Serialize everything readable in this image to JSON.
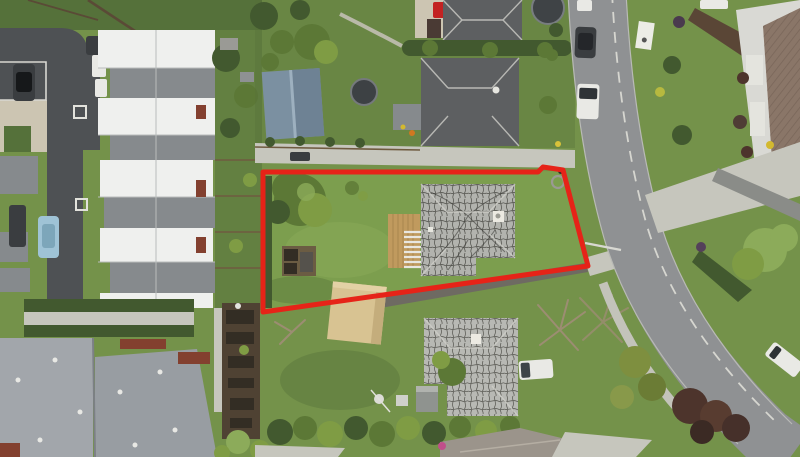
{
  "meta": {
    "type": "aerial-drone-photograph",
    "description": "Aerial real-estate photo of a suburban section outlined in red, surrounded by townhouses on the left, neighbouring houses above and below, and a curved street on the right",
    "width_px": 800,
    "height_px": 457
  },
  "colors": {
    "grass_base": "#74924a",
    "grass_dark": "#55713a",
    "grass_light": "#8cab5a",
    "lot_lawn": "#7c9e4e",
    "road_asphalt": "#8f9193",
    "road_edge": "#b9bab6",
    "road_dash": "#d6d6d0",
    "asphalt_dark": "#4e5154",
    "concrete": "#c6c6bd",
    "concrete_warm": "#ccc5b2",
    "roof_white": "#eff0ee",
    "roof_gray": "#868a8d",
    "roof_dark": "#5d5f61",
    "roof_modern": "#a2a6ab",
    "roof_modern2": "#989da2",
    "brick_red": "#83402f",
    "subject_roof": "#b2b3ae",
    "neighbor_roof": "#b8b9b4",
    "roof_vein": "#45453f",
    "deck_tan": "#c09a5e",
    "garage_tan": "#d8c392",
    "shed_blue": "#7b90a1",
    "garden_soil": "#4f4233",
    "garden_bed": "#332d24",
    "hedge_dark": "#42592f",
    "tree_green": "#5c7836",
    "tree_light": "#7f9c44",
    "bush_maroon": "#4d342c",
    "vehicle_white": "#e9e9e5",
    "car_blue": "#9fc3d6",
    "car_red": "#c32222",
    "vehicle_dark": "#3a3d40",
    "roof_brown": "#8a7668",
    "boundary_red": "#e62318"
  },
  "boundary": {
    "points": "263,172 538,172 543,167 563,170 588,266 263,312",
    "stroke_width_px": 5
  },
  "road": {
    "center_d": "M 597,-8 C 601,75 612,160 633,232 C 655,306 700,372 766,436 L 792,455",
    "dash_d": "M 612,-8 C 616,72 627,155 647,226 C 668,295 712,360 776,422",
    "left_edge_d": "M 568,-8 C 572,78 583,164 604,238 C 626,312 672,380 738,444",
    "right_edge_d": "M 626,-8 C 630,72 641,154 661,225 C 683,296 728,362 792,424",
    "footpath_d": "M 603,283 C 620,330 650,380 688,420"
  },
  "scene_objects": [
    "red boundary overlay around the advertised section",
    "subject house with weathered grey tiled roof and dark moss veins",
    "timber deck with white pergola slats",
    "tan flat-roofed garage crossing the lower boundary line",
    "large tree and vegetable garden inside the section",
    "shared concrete driveway above the section",
    "two neighbouring houses with dark grey roofs, two trampolines, blue-grey shed",
    "terraced townhouse row with alternating white and grey roofs",
    "dark asphalt parking court and rear lane with parked cars",
    "modern grey apartment roofs with brick walls and community garden plots",
    "curved suburban street with dashed centreline, parked cars and white vans",
    "neighbouring house below with matching weathered roof, white ute, sheds, bare trees",
    "street-front lawns, hedges and maroon shrubs on the right"
  ],
  "vehicle_count": 11
}
